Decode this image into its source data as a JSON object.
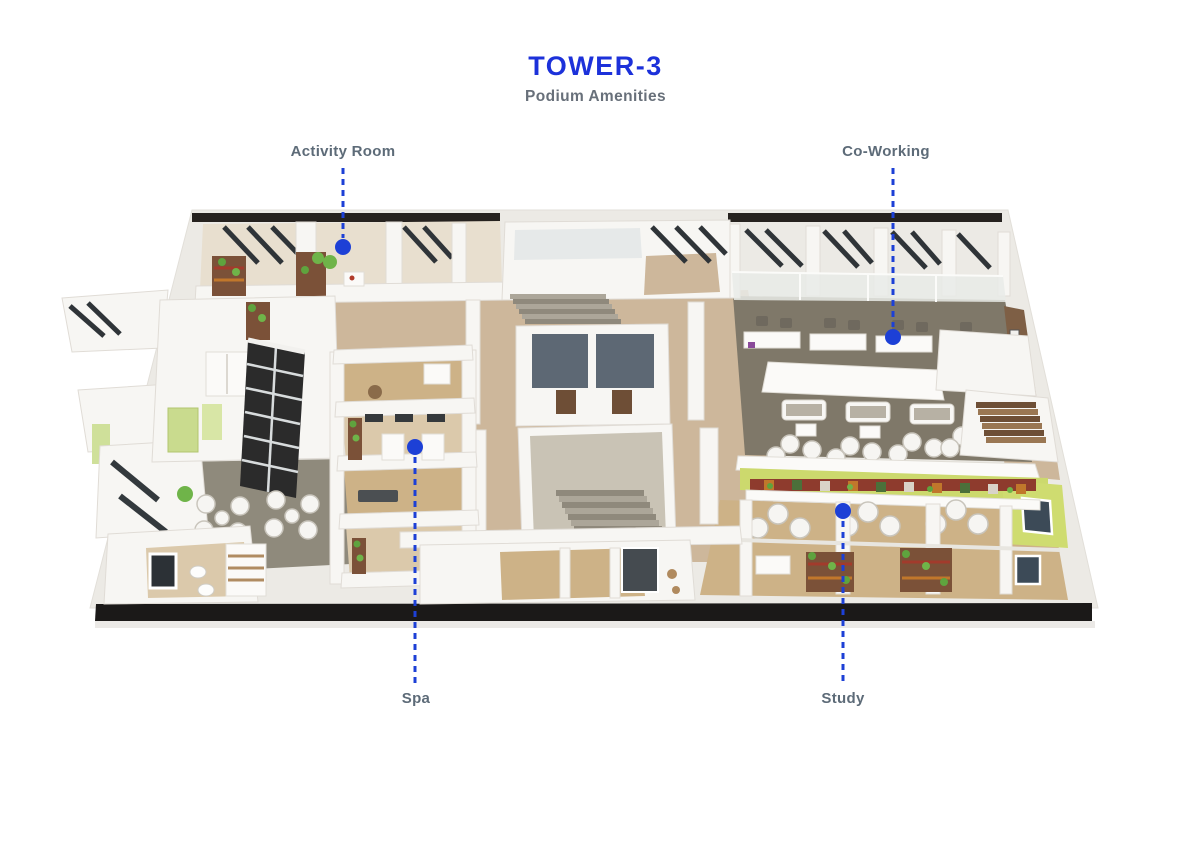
{
  "header": {
    "title": "TOWER-3",
    "subtitle": "Podium Amenities"
  },
  "annotations": [
    {
      "label": "Activity Room",
      "target": "activity-room",
      "position": "top-left"
    },
    {
      "label": "Co-Working",
      "target": "co-working",
      "position": "top-right"
    },
    {
      "label": "Spa",
      "target": "spa",
      "position": "bottom-left"
    },
    {
      "label": "Study",
      "target": "study",
      "position": "bottom-right"
    }
  ],
  "colors": {
    "title_blue": "#1c31da",
    "marker_blue": "#1d40d6",
    "label_gray": "#5d6b78",
    "subtitle_gray": "#68707a",
    "floor_beige": "#cdb79b",
    "carpet_gray": "#7f7869",
    "wood_floor": "#cdb287",
    "accent_green_wall": "#ccd96d",
    "slab_black": "#26221f"
  }
}
